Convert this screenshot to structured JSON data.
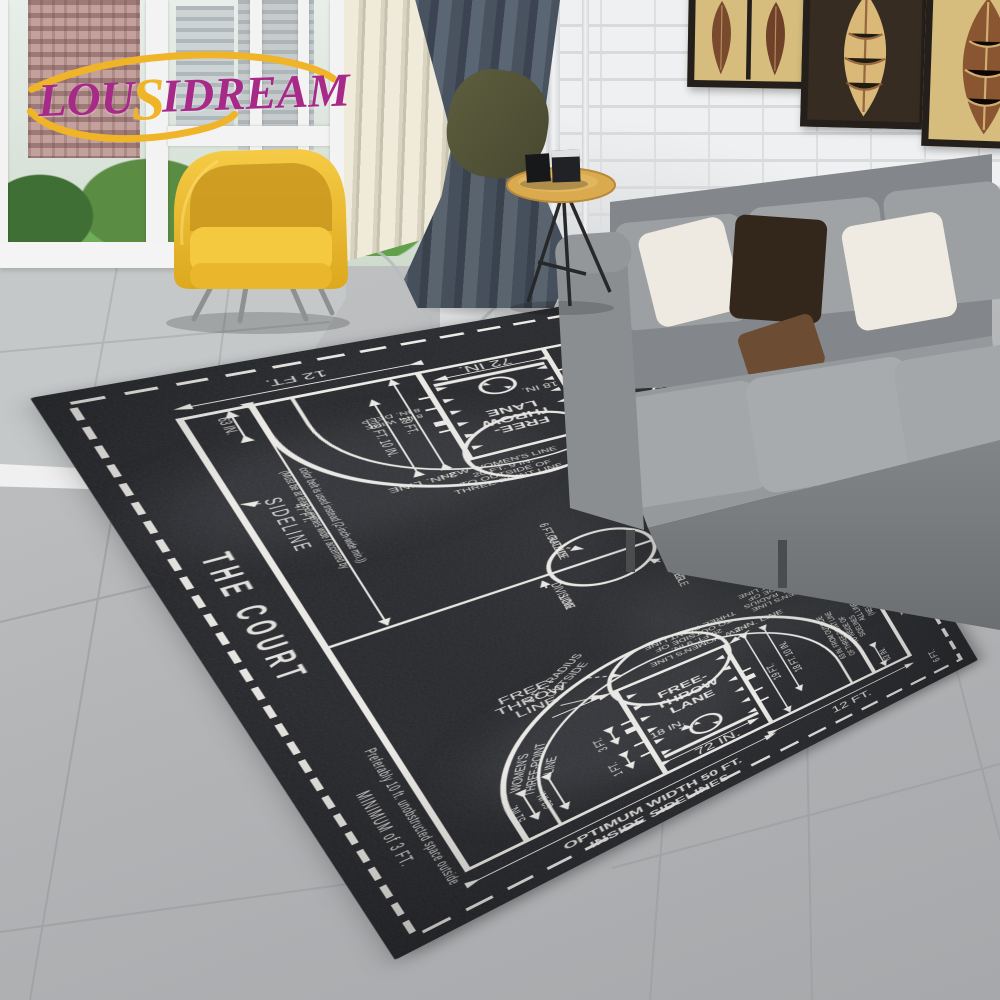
{
  "watermark": {
    "text_pre": "LOU",
    "text_s": "S",
    "text_post": "IDREAM",
    "text_color": "#a82a88",
    "swoosh_color": "#f0b428"
  },
  "scene": {
    "wall_color": "#eff0f1",
    "floor_color": "#b7b9bb",
    "curtain_color": "#4e5866",
    "blinds_color": "#e9e4d3",
    "sofa_color": "#9b9ea1",
    "armchair_color": "#f2c43c",
    "table_color": "#d8a94e",
    "pillow_colors": [
      "#efeae1",
      "#33261b",
      "#6d4c34",
      "#f0ebe2"
    ],
    "art_frame_count": 3
  },
  "rug": {
    "base_color": "#26272b",
    "line_color": "#eae9e5",
    "title": "THE COURT",
    "labels": {
      "sideline": "SIDELINE",
      "sideline_note_1": "(Must be at least 3 inches wide / accented by",
      "sideline_note_2": "color belt is used instead (2-inch-wide min.))",
      "minimum_3ft": "MINIMUM of 3 FT.",
      "preferably": "Preferably 10 ft. unobstructed space outside",
      "optimum_1": "OPTIMUM WIDTH 50 FT.",
      "optimum_2": "INSIDE SIDELINES",
      "division_1": "DIVISION",
      "division_2": "LINE",
      "center_1": "CENTER",
      "center_2": "CIRCLE",
      "radius_1": "6 FT. RADIUS",
      "radius_2": "OUTSIDE",
      "ft_line_1": "FREE-",
      "ft_line_2": "THROW",
      "ft_line_3": "LINE",
      "ft_lane_1": "FREE-",
      "ft_lane_2": "THROW",
      "ft_lane_3": "LANE",
      "womens_1": "WOMEN'S",
      "womens_2": "THREE-POINT",
      "womens_3": "LINE",
      "new_mens_1": "NEW MEN'S LINE",
      "new_mens_2": "21 FT. 9 IN. RADIUS",
      "new_mens_3": "TO OUTSIDE OF",
      "new_mens_4": "THREE-POINT LINE",
      "new_womens_1": "NEW WOMEN'S LINE",
      "new_womens_2": "20 FT. 9 IN.",
      "new_womens_3": "TO OUTSIDE OF",
      "new_womens_4": "THREE-POINT LINE",
      "two_in_line": "2 IN. LINE",
      "coaching_1": "COACHING BOX:",
      "coaching_2": "2 IN. WIDE BY 3 FT. DEEP AND",
      "coaching_3": "3 FT. EXTENDED ONTO COURT",
      "team_bench_1": "TEAM BENCH",
      "team_bench_2": "AREA",
      "all_lines_1": "ALL LINES SHALL BE 2 IN. WIDE",
      "all_lines_2": "(NEUTRAL ZONES EXCLUDED)",
      "scorers_table": "SCORER'S TABLE",
      "x_mark": "X",
      "length_94": "LENGTH 94 FT.",
      "from_outside_1": "63 IN. FROM OUTSIDE",
      "from_outside_2": "OF THREE-POINT LINE",
      "from_outside_3": "TO INSIDE OF",
      "from_outside_4": "SIDELINES",
      "color_note_1": "THE COLOR OF THE LANE",
      "color_note_2": "SHALL CONTRAST WITH",
      "color_note_3": "THE COLOR OF THE COURT",
      "x_note_1": "AN 'X', BASKETBALL LOGO",
      "x_note_2": "SEE RULE 1-13"
    },
    "dims": {
      "d50": "50 FT.",
      "d47": "47 FT.",
      "d12": "12 FT.",
      "d6": "6 FT.",
      "d19": "19 FT.",
      "d18_10": "18 FT. 10 IN.",
      "d63": "63 IN.",
      "d51": "51 IN.",
      "d72": "72 IN.",
      "d18": "18 IN.",
      "d3": "3 FT.",
      "d1": "1 FT.",
      "d4": "4 FT.",
      "wide8": "8 IN. WIDE",
      "deep8": "8 IN. DEEP"
    }
  }
}
